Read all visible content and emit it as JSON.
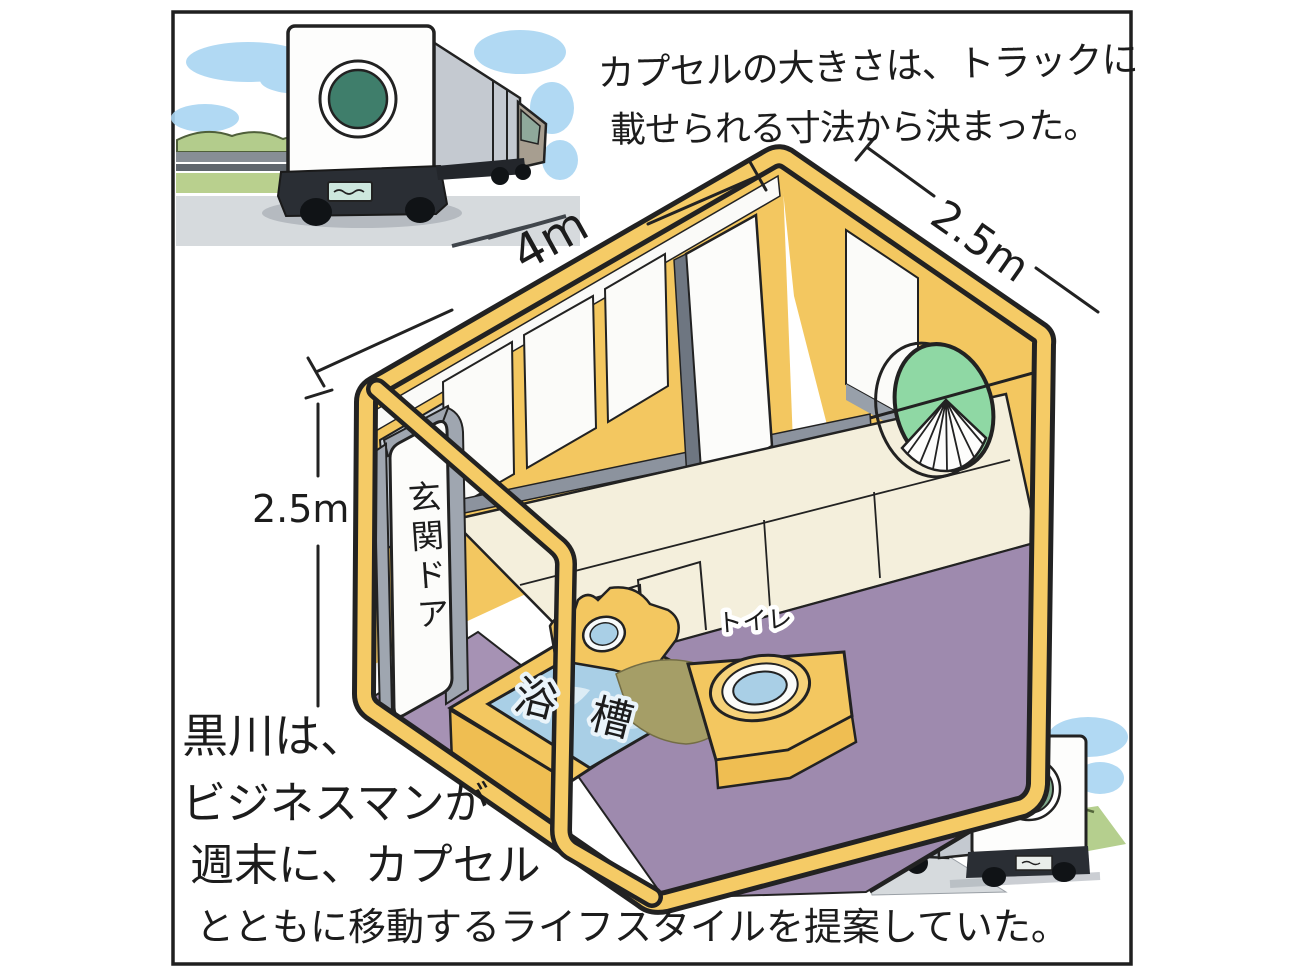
{
  "captions": {
    "top": [
      "カプセルの大きさは、トラックに",
      "載せられる寸法から決まった。"
    ],
    "bottom": [
      "黒川は、",
      "ビジネスマンが",
      "週末に、カプセル",
      "とともに移動するライフスタイルを提案していた。"
    ]
  },
  "dimensions": {
    "length": "4m",
    "depth": "2.5m",
    "height": "2.5m"
  },
  "labels": {
    "entrance_door": "玄関ドア",
    "bathtub": "浴槽",
    "toilet": "トイレ"
  },
  "scenes": {
    "top_left": "truck-carrying-capsule-rear-view",
    "bottom_right": "truck-carrying-capsule-toward-mt-fuji",
    "center": "capsule-interior-cutaway"
  },
  "colors": {
    "capsule_yellow": "#F3C760",
    "floor_purple": "#9E8AAE",
    "water_blue": "#A9CFE6",
    "porthole_green": "#8FD8A4",
    "truck_porthole_green": "#3F7E6B",
    "bed_cream": "#F4EFDC",
    "frame_gray": "#9FA6B0",
    "sky_blue": "#A9D5F2",
    "grass_green": "#B9D08E",
    "fuji_blue": "#5B7DB5",
    "ink": "#1c1c1c"
  }
}
